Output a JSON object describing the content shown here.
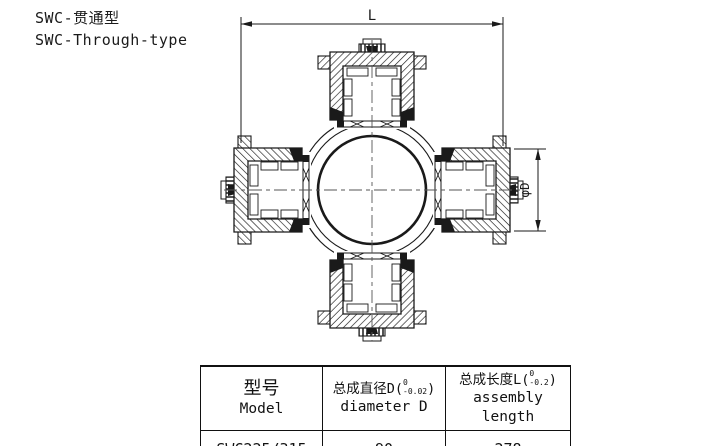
{
  "title": {
    "line1": "SWC-贯通型",
    "line2": "SWC-Through-type"
  },
  "drawing": {
    "type": "universal-joint-cross-section",
    "dim_length_label": "L",
    "dim_diameter_label": "φD",
    "line_color": "#1a1a1a"
  },
  "table": {
    "columns": [
      {
        "zh": "型号",
        "en": "Model"
      },
      {
        "zh_prefix": "总成直径D(",
        "tol_top": "0",
        "tol_bottom": "-0.02",
        "suffix": ")",
        "en": "diameter D"
      },
      {
        "zh_prefix": "总成长度L(",
        "tol_top": "0",
        "tol_bottom": "-0.2",
        "suffix": ")",
        "en": "assembly length"
      }
    ],
    "rows": [
      [
        "SWC225/315",
        "90",
        "278"
      ]
    ]
  }
}
